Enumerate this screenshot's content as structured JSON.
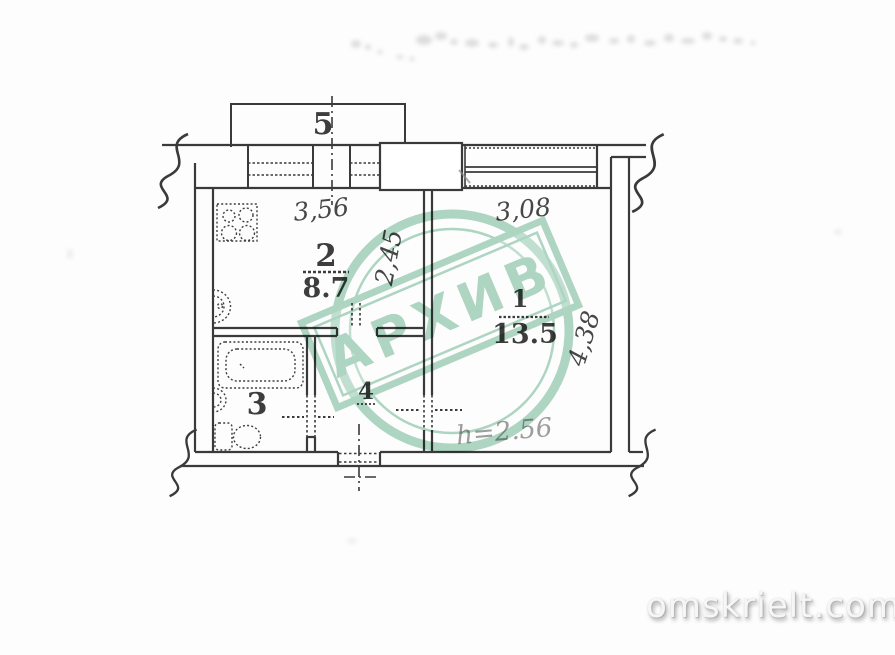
{
  "plan": {
    "rooms": {
      "balcony": {
        "label": "5"
      },
      "kitchen": {
        "label": "2",
        "area": "8.7"
      },
      "living": {
        "label": "1",
        "area": "13.5"
      },
      "bathroom": {
        "label": "3"
      },
      "hall": {
        "label": "4"
      }
    },
    "dimensions": {
      "kitchen_width": "3,56",
      "kitchen_depth": "2,45",
      "living_width": "3,08",
      "living_depth": "4,38",
      "height_note": "h=2.56"
    },
    "icons": [
      "stove-icon",
      "kitchen-sink-icon",
      "bathtub-icon",
      "washbasin-icon",
      "toilet-icon"
    ]
  },
  "watermark": {
    "stamp_text": "АРХИВ",
    "site_text": "omskrielt.com"
  },
  "colors": {
    "line": "#3a3a3a",
    "stamp": "#5fae87",
    "height_text": "#9d9d9d",
    "faint_text": "#8f8f8f"
  }
}
